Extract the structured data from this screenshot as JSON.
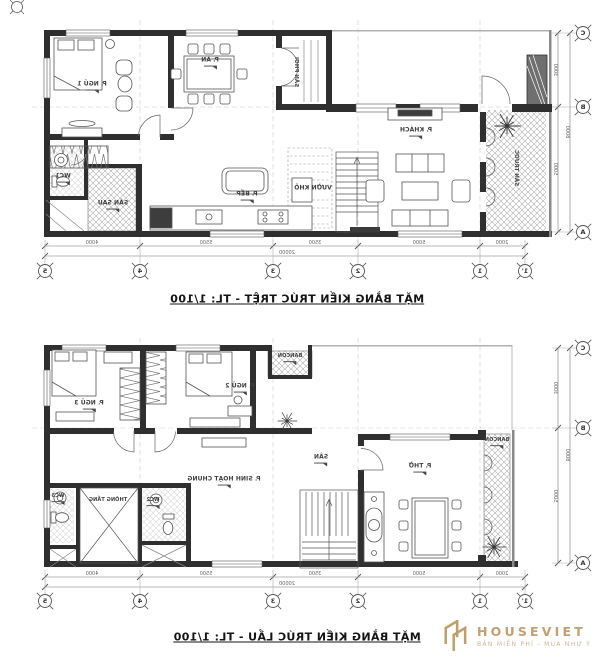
{
  "sheet": {
    "ground": {
      "title": "MẶT BẰNG KIẾN TRÚC TRỆT - TL: 1/100",
      "rooms": [
        {
          "name": "P. NGỦ 1"
        },
        {
          "name": "P. ĂN"
        },
        {
          "name": "P. BẾP"
        },
        {
          "name": "P. KHÁCH"
        },
        {
          "name": "WC1"
        },
        {
          "name": "SÂN SAU"
        },
        {
          "name": "VƯỜN KHÔ"
        },
        {
          "name": "SÂN PHƠI"
        },
        {
          "name": "SÂN TRƯỚC"
        }
      ]
    },
    "upper": {
      "title": "MẶT BẰNG KIẾN TRÚC LẦU - TL: 1/100",
      "rooms": [
        {
          "name": "P. NGỦ 3"
        },
        {
          "name": "P. NGỦ 2"
        },
        {
          "name": "BANCON"
        },
        {
          "name": "P. SINH HOẠT CHUNG"
        },
        {
          "name": "THÔNG TẦNG"
        },
        {
          "name": "WC3"
        },
        {
          "name": "WC2"
        },
        {
          "name": "SÂN"
        },
        {
          "name": "P. THỜ"
        },
        {
          "name": "BANCON"
        }
      ]
    },
    "dims": {
      "h_segments": [
        "4000",
        "5500",
        "3500",
        "5000",
        "2000"
      ],
      "h_total": "20000",
      "v_segments": [
        "3000",
        "5000"
      ],
      "v_total": "8000",
      "h_axes": [
        "5",
        "4",
        "3",
        "2",
        "1",
        "1'"
      ],
      "v_axes": [
        "C",
        "B",
        "A"
      ]
    },
    "colors": {
      "wall": "#2f2f2f",
      "hatch": "#ababab",
      "logo_gold": "#c2a073"
    },
    "logo": {
      "name": "HOUSEVIET",
      "tagline": "BẢN MIỄN PHÍ - MUA NHƯ Ý"
    }
  }
}
